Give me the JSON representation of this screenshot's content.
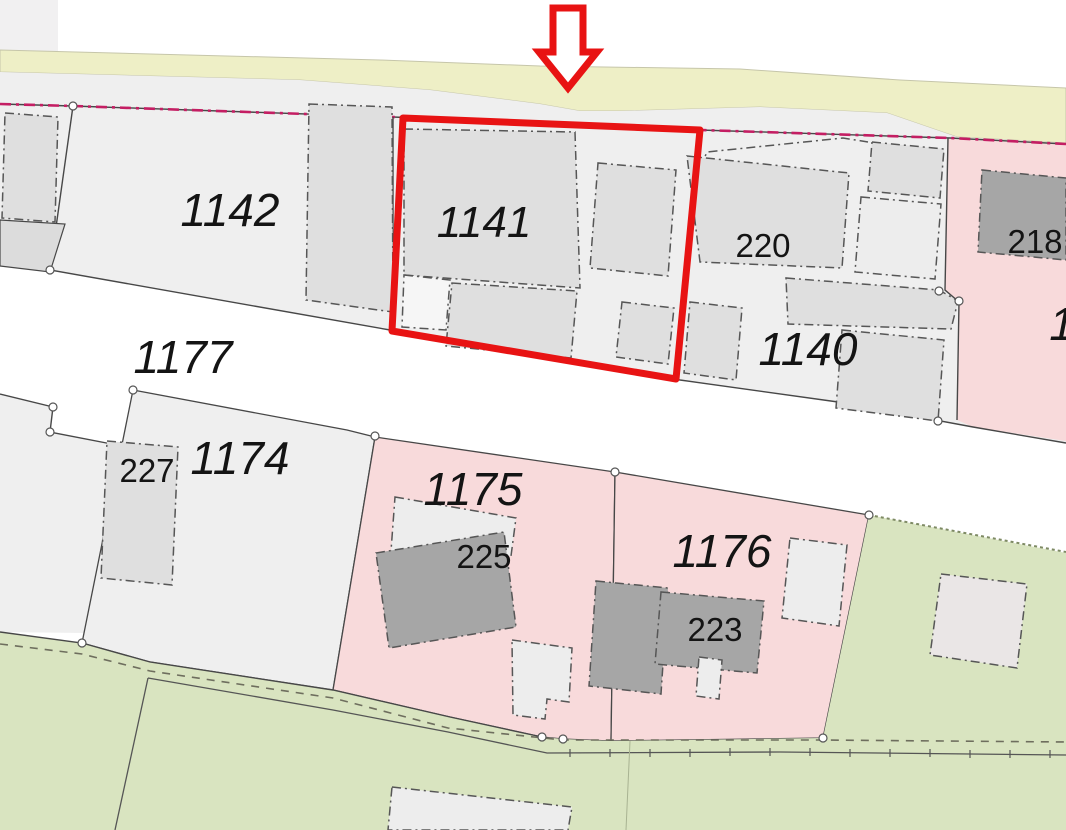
{
  "map": {
    "kind": "cadastral-parcel-map",
    "marker": {
      "icon": "down-arrow-icon",
      "color": "#e81313"
    },
    "highlighted_parcel": {
      "label": "1141",
      "outline_color": "#e81313"
    },
    "parcels": [
      {
        "label": "1142"
      },
      {
        "label": "1141",
        "highlighted": true
      },
      {
        "label": "1140"
      },
      {
        "label": "1177"
      },
      {
        "label": "1174"
      },
      {
        "label": "1175"
      },
      {
        "label": "1176"
      },
      {
        "label": "1",
        "partial": true
      }
    ],
    "buildings": [
      {
        "label": "220"
      },
      {
        "label": "218"
      },
      {
        "label": "227"
      },
      {
        "label": "225"
      },
      {
        "label": "223"
      }
    ],
    "colors": {
      "highlight-red": "#e81313",
      "magenta-boundary": "#c41e63",
      "parcel-gray": "#efefef",
      "parcel-pink": "#f8dadb",
      "grass-green": "#d9e4c0",
      "road-strip-yellow": "#eeefc6",
      "building-gray": "#dfdfdf",
      "building-dark": "#a6a6a6",
      "building-light": "#ededed",
      "line-dark": "#474747",
      "label-dark": "#141414",
      "white": "#ffffff"
    }
  }
}
